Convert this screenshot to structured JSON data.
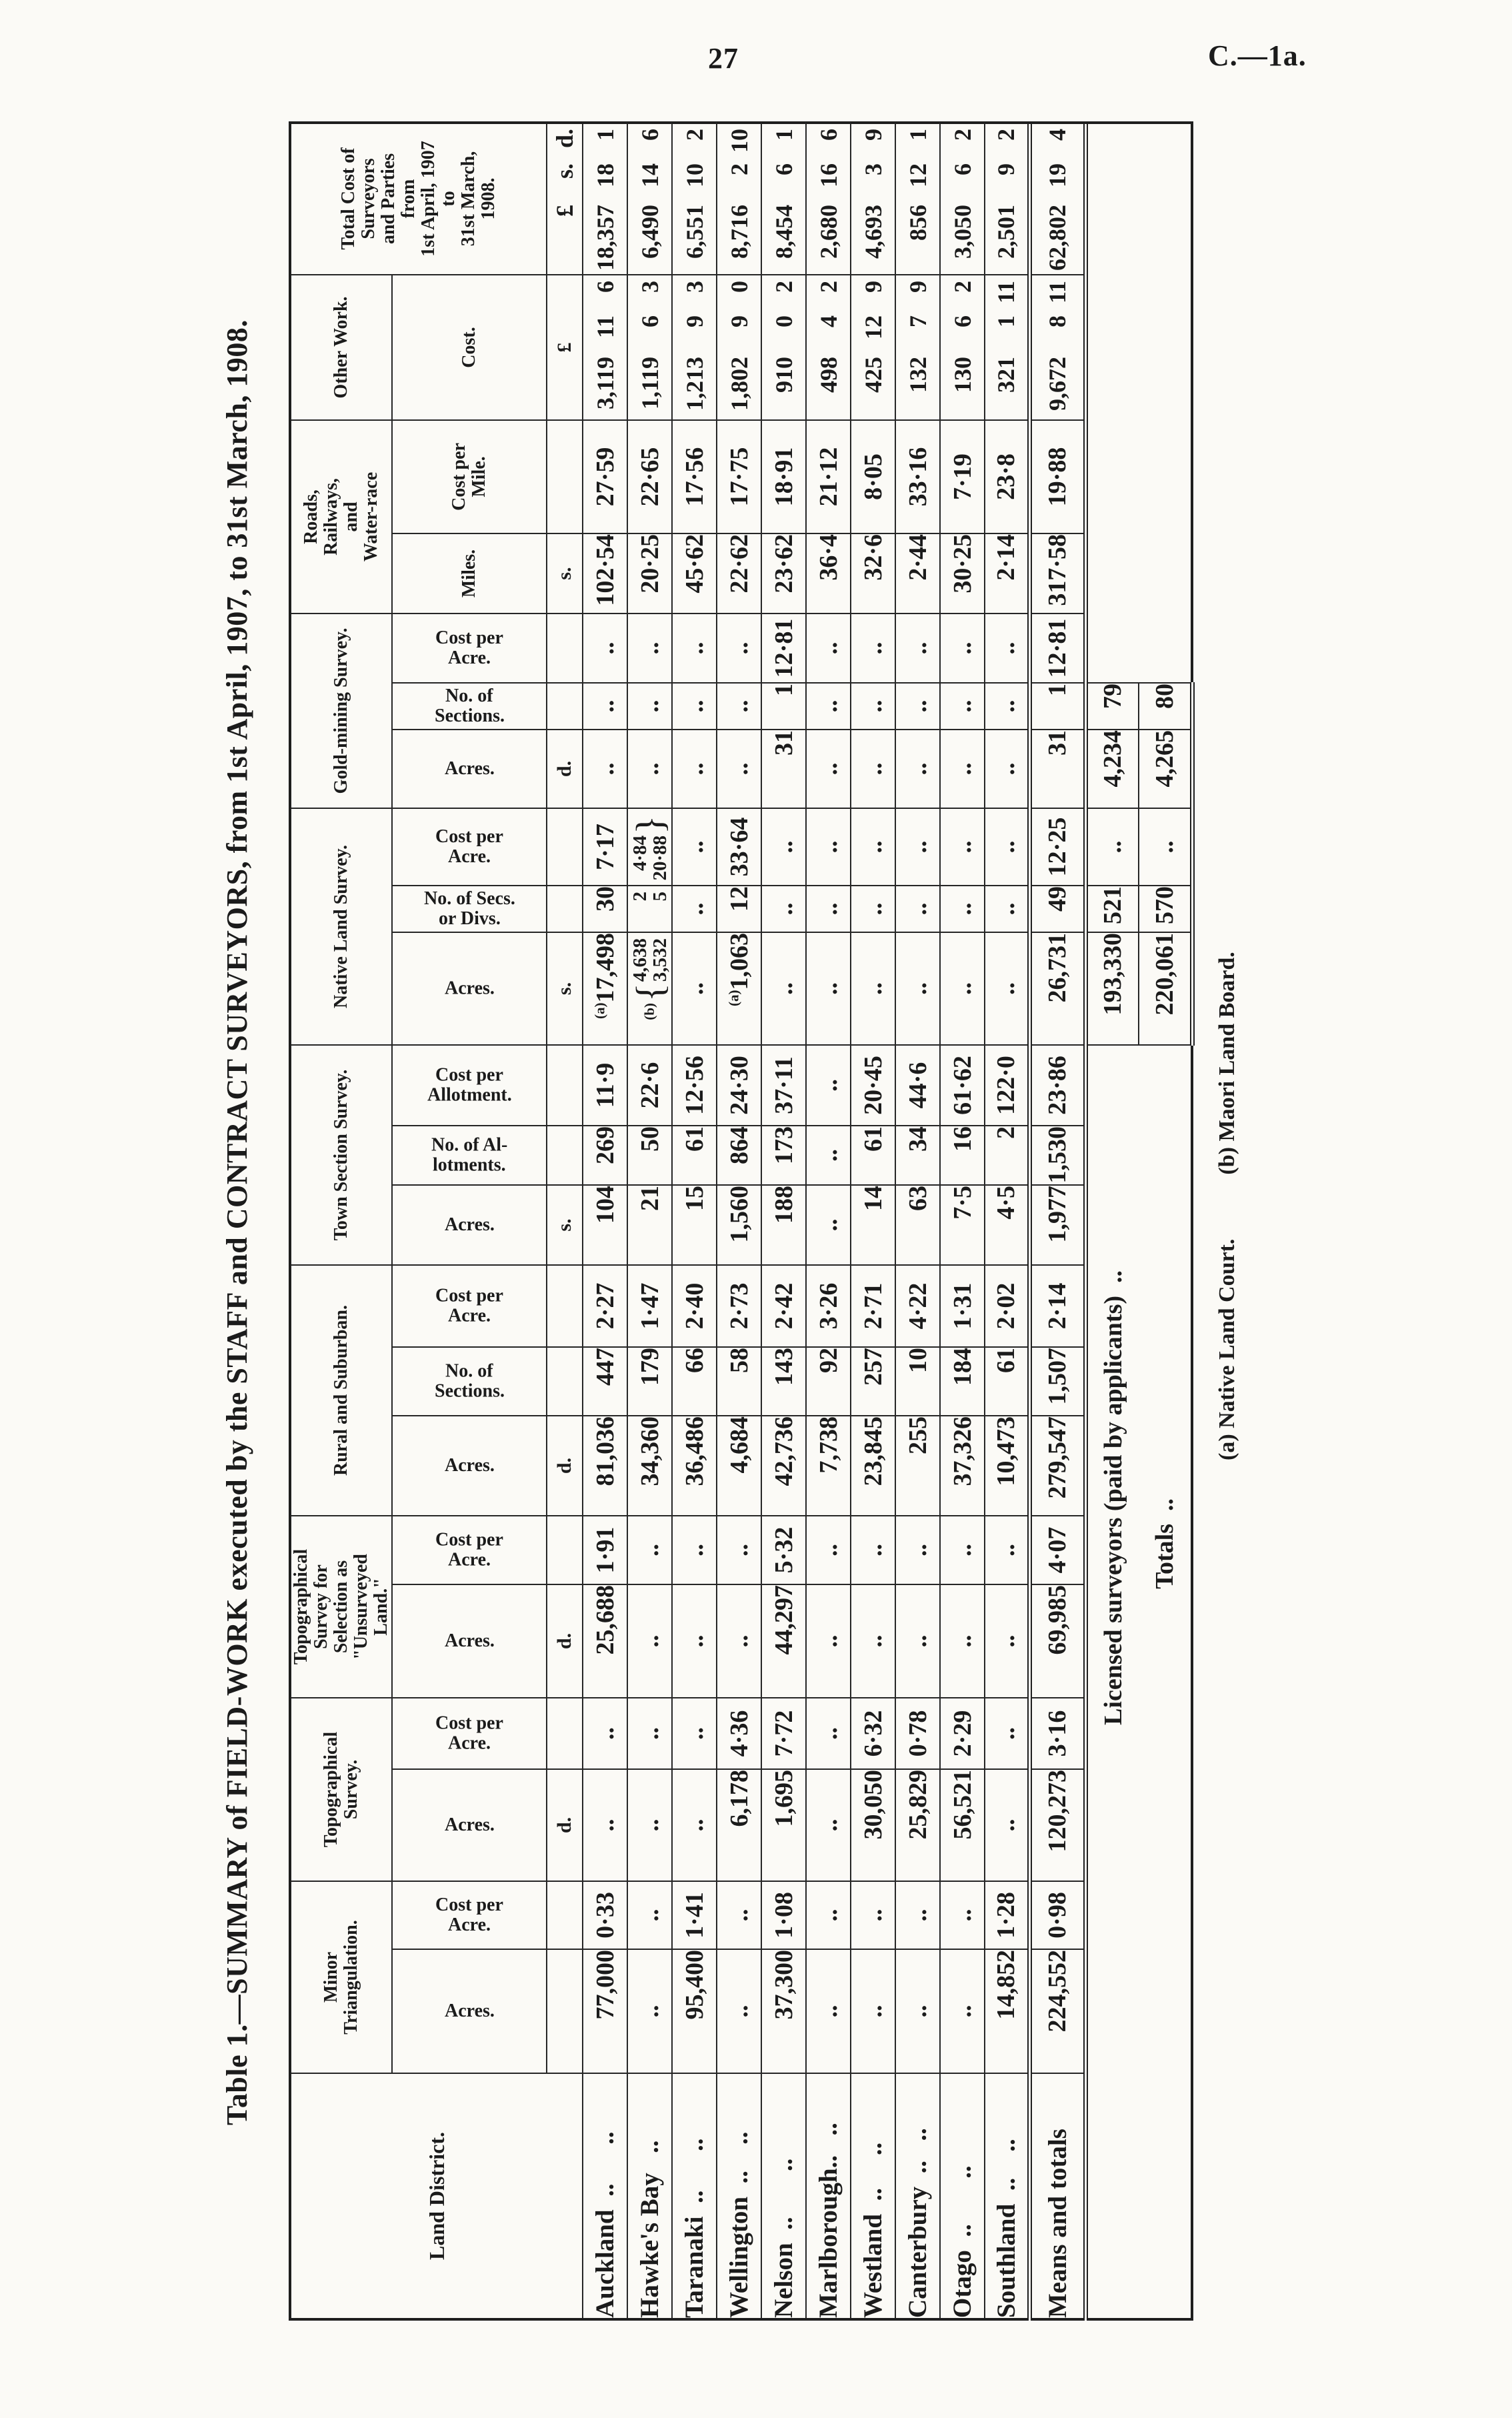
{
  "page": {
    "number": "27",
    "doc_ref": "C.—1a."
  },
  "title": "Table 1.—SUMMARY of FIELD-WORK executed by the STAFF and CONTRACT SURVEYORS, from 1st April, 1907, to 31st March, 1908.",
  "table": {
    "land_district_header": "Land District.",
    "groups": [
      {
        "label": "Minor\nTriangulation.",
        "subs": [
          {
            "label": "Acres.",
            "vertical": true,
            "unit": ""
          },
          {
            "label": "Cost per\nAcre.",
            "vertical": true,
            "unit": "d."
          }
        ]
      },
      {
        "label": "Topographical\nSurvey.",
        "subs": [
          {
            "label": "Acres.",
            "vertical": true,
            "unit": ""
          },
          {
            "label": "Cost per\nAcre.",
            "vertical": true,
            "unit": "d."
          }
        ]
      },
      {
        "label": "Topographical\nSurvey for\nSelection as\n\"Unsurveyed\nLand.\"",
        "subs": [
          {
            "label": "Acres.",
            "vertical": true,
            "unit": ""
          },
          {
            "label": "Cost per\nAcre.",
            "vertical": true,
            "unit": "d."
          }
        ]
      },
      {
        "label": "Rural and Suburban.",
        "subs": [
          {
            "label": "Acres.",
            "vertical": true,
            "unit": ""
          },
          {
            "label": "No. of\nSections.",
            "vertical": true,
            "unit": ""
          },
          {
            "label": "Cost per\nAcre.",
            "vertical": true,
            "unit": "s."
          }
        ]
      },
      {
        "label": "Town Section Survey.",
        "subs": [
          {
            "label": "Acres.",
            "vertical": true,
            "unit": ""
          },
          {
            "label": "No. of Al-\nlotments.",
            "vertical": true,
            "unit": ""
          },
          {
            "label": "Cost per\nAllotment.",
            "vertical": true,
            "unit": "s."
          }
        ]
      },
      {
        "label": "Native Land Survey.",
        "subs": [
          {
            "label": "Acres.",
            "vertical": true,
            "unit": ""
          },
          {
            "label": "No. of Secs.\nor Divs.",
            "vertical": true,
            "unit": ""
          },
          {
            "label": "Cost per\nAcre.",
            "vertical": true,
            "unit": "d."
          }
        ]
      },
      {
        "label": "Gold-mining Survey.",
        "subs": [
          {
            "label": "Acres.",
            "vertical": true,
            "unit": ""
          },
          {
            "label": "No. of\nSections.",
            "vertical": true,
            "unit": ""
          },
          {
            "label": "Cost per\nAcre.",
            "vertical": true,
            "unit": "s."
          }
        ]
      },
      {
        "label": "Roads,\nRailways,\nand\nWater-race",
        "subs": [
          {
            "label": "Miles.",
            "vertical": false,
            "unit": ""
          },
          {
            "label": "Cost per\nMile.",
            "vertical": false,
            "unit": "£"
          }
        ]
      },
      {
        "label": "Other Work.",
        "subs": [
          {
            "label": "Cost.",
            "vertical": false,
            "unit": "£ s. d."
          }
        ]
      },
      {
        "label": "Total Cost of\nSurveyors\nand Parties\nfrom\n1st April, 1907\nto\n31st March,\n1908.",
        "subs": [
          {
            "label": "",
            "vertical": false,
            "unit": "£ s. d."
          }
        ]
      }
    ],
    "rows": [
      {
        "district": "Auckland  ..      ..",
        "cells": [
          "77,000",
          "0·33",
          "..",
          "..",
          "25,688",
          "1·91",
          "81,036",
          "447",
          "2·27",
          "104",
          "269",
          "11·9",
          "(a)17,498",
          "30",
          "7·17",
          "..",
          "..",
          "..",
          "102·54",
          "27·59",
          "3,119 11 6",
          "18,357 18 1"
        ]
      },
      {
        "district": "Hawke's Bay   ..",
        "cells": [
          "..",
          "..",
          "..",
          "..",
          "..",
          "..",
          "34,360",
          "179",
          "1·47",
          "21",
          "50",
          "22·6",
          {
            "prefix": "(b)",
            "brace_left": "{",
            "lines": [
              "4,638",
              "3,532"
            ]
          },
          {
            "lines": [
              "2",
              "5"
            ]
          },
          {
            "brace_right": "}",
            "lines": [
              "4·84",
              "20·88"
            ]
          },
          "..",
          "..",
          "..",
          "20·25",
          "22·65",
          "1,119 6 3",
          "6,490 14 6"
        ]
      },
      {
        "district": "Taranaki  ..      ..",
        "cells": [
          "95,400",
          "1·41",
          "..",
          "..",
          "..",
          "..",
          "36,486",
          "66",
          "2·40",
          "15",
          "61",
          "12·56",
          "..",
          "..",
          "..",
          "..",
          "..",
          "..",
          "45·62",
          "17·56",
          "1,213 9 3",
          "6,551 10 2"
        ]
      },
      {
        "district": "Wellington  ..    ..",
        "cells": [
          "..",
          "..",
          "6,178",
          "4·36",
          "..",
          "..",
          "4,684",
          "58",
          "2·73",
          "1,560",
          "864",
          "24·30",
          "(a)1,063",
          "12",
          "33·64",
          "..",
          "..",
          "..",
          "22·62",
          "17·75",
          "1,802 9 0",
          "8,716 2 10"
        ]
      },
      {
        "district": "Nelson  ..       ..",
        "cells": [
          "37,300",
          "1·08",
          "1,695",
          "7·72",
          "44,297",
          "5·32",
          "42,736",
          "143",
          "2·42",
          "188",
          "173",
          "37·11",
          "..",
          "..",
          "..",
          "31",
          "1",
          "12·81",
          "23·62",
          "18·91",
          "910 0 2",
          "8,454 6 1"
        ]
      },
      {
        "district": "Marlborough..   ..",
        "cells": [
          "..",
          "..",
          "..",
          "..",
          "..",
          "..",
          "7,738",
          "92",
          "3·26",
          "..",
          "..",
          "..",
          "..",
          "..",
          "..",
          "..",
          "..",
          "..",
          "36·4",
          "21·12",
          "498 4 2",
          "2,680 16 6"
        ]
      },
      {
        "district": "Westland  ..     ..",
        "cells": [
          "..",
          "..",
          "30,050",
          "6·32",
          "..",
          "..",
          "23,845",
          "257",
          "2·71",
          "14",
          "61",
          "20·45",
          "..",
          "..",
          "..",
          "..",
          "..",
          "..",
          "32·6",
          "8·05",
          "425 12 9",
          "4,693 3 9"
        ]
      },
      {
        "district": "Canterbury  ..   ..",
        "cells": [
          "..",
          "..",
          "25,829",
          "0·78",
          "..",
          "..",
          "255",
          "10",
          "4·22",
          "63",
          "34",
          "44·6",
          "..",
          "..",
          "..",
          "..",
          "..",
          "..",
          "2·44",
          "33·16",
          "132 7 9",
          "856 12 1"
        ]
      },
      {
        "district": "Otago  ..       ..",
        "cells": [
          "..",
          "..",
          "56,521",
          "2·29",
          "..",
          "..",
          "37,326",
          "184",
          "1·31",
          "7·5",
          "16",
          "61·62",
          "..",
          "..",
          "..",
          "..",
          "..",
          "..",
          "30·25",
          "7·19",
          "130 6 2",
          "3,050 6 2"
        ]
      },
      {
        "district": "Southland  ..    ..",
        "cells": [
          "14,852",
          "1·28",
          "..",
          "..",
          "..",
          "..",
          "10,473",
          "61",
          "2·02",
          "4·5",
          "2",
          "122·0",
          "..",
          "..",
          "..",
          "..",
          "..",
          "..",
          "2·14",
          "23·8",
          "321 1 11",
          "2,501 9 2"
        ]
      }
    ],
    "totals_row": {
      "district": "Means and totals",
      "cells": [
        "224,552",
        "0·98",
        "120,273",
        "3·16",
        "69,985",
        "4·07",
        "279,547",
        "1,507",
        "2·14",
        "1,977",
        "1,530",
        "23·86",
        "26,731",
        "49",
        "12·25",
        "31",
        "1",
        "12·81",
        "317·58",
        "19·88",
        "9,672 8 11",
        "62,802 19 4"
      ]
    },
    "extra_rows": [
      {
        "label": "Licensed surveyors (paid by applicants)  ..",
        "native_acres": "193,330",
        "native_secs": "521",
        "native_cost": "..",
        "gold_acres": "4,234",
        "gold_secs": "79",
        "pad_right": 8
      },
      {
        "label": "Totals  ..",
        "native_acres": "220,061",
        "native_secs": "570",
        "native_cost": "..",
        "gold_acres": "4,265",
        "gold_secs": "80",
        "pad_right": 350
      }
    ],
    "footnotes": [
      "(a) Native Land Court.",
      "(b) Maori Land Board."
    ]
  }
}
